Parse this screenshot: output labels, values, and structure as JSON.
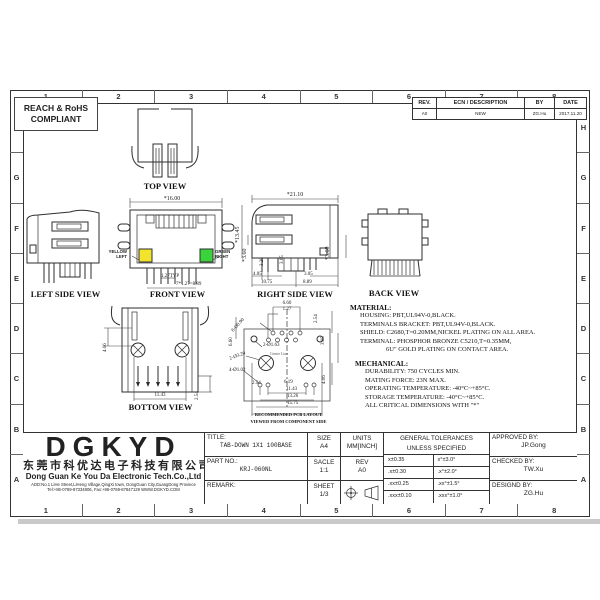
{
  "compliance": {
    "line1": "REACH & RoHS",
    "line2": "COMPLIANT"
  },
  "border": {
    "columns": [
      "1",
      "2",
      "3",
      "4",
      "5",
      "6",
      "7",
      "8"
    ],
    "rows": [
      "H",
      "G",
      "F",
      "E",
      "D",
      "C",
      "B",
      "A"
    ]
  },
  "revision": {
    "headers": [
      "REV.",
      "ECN / DESCRIPTION",
      "BY",
      "DATE"
    ],
    "rev": "A0",
    "description": "NEW",
    "by": "ZG.Hu",
    "date": "2017.11.20"
  },
  "views": {
    "top": {
      "caption": "TOP VIEW"
    },
    "left": {
      "caption": "LEFT SIDE VIEW"
    },
    "front": {
      "caption": "FRONT VIEW",
      "width": "*16.00",
      "pitch": "1.27TYP",
      "span": "7*1.27=8.89",
      "led_left_1": "YELLOW",
      "led_left_2": "LEFT",
      "led_right_1": "GREEN",
      "led_right_2": "RIGHT",
      "led_left_color": "#f2e42c",
      "led_right_color": "#3bd33b"
    },
    "right": {
      "caption": "RIGHT SIDE VIEW",
      "width": "*21.10",
      "height": "*13.45",
      "dim_360_left": "*3.60",
      "dim_320": "3.20",
      "dim_365": "3.65",
      "dim_360_right": "*3.60",
      "dim_405": "4.05",
      "dim_305": "3.05",
      "dim_1075": "10.75",
      "dim_889": "8.89"
    },
    "back": {
      "caption": "BACK VIEW"
    },
    "bottom": {
      "caption": "BOTTOM VIEW",
      "dim_406": "4.06",
      "dim_1143": "11.43",
      "dim_254": "2.54"
    },
    "pcb": {
      "caption1": "RECOMMENDED PCB LAYOUT",
      "caption2": "VIEWED FROM COMPONENT SIDE",
      "dim_660_top": "6.60",
      "dim_127": "1.27",
      "dim_254_right": "2.54",
      "dim_305": "3.05",
      "dim_406": "4.06",
      "dim_660_left": "6.60",
      "holes_090": "8-Ø0.90",
      "holes_163": "2-Ø1.63",
      "holes_320": "2-Ø3.20",
      "holes_102": "4-Ø1.02",
      "dim_254_bottom": "2.54",
      "dim_619": "6.19",
      "dim_1143": "11.43",
      "dim_1326": "13.26",
      "dim_1575": "15.75",
      "centre_line": "Centre Line"
    }
  },
  "material": {
    "heading": "MATERIAL:",
    "lines": [
      "HOUSING: PBT,UL94V-0,BLACK.",
      "TERMINALS BRACKET: PBT,UL94V-0,BLACK.",
      "SHIELD: C2680,T=0.20MM,NICKEL PLATING ON ALL AREA.",
      "TERMINAL: PHOSPHOR BRONZE C5210,T=0.35MM,",
      "6U\" GOLD PLATING ON CONTACT AREA."
    ]
  },
  "mechanical": {
    "heading": "MECHANICAL:",
    "lines": [
      "DURABILITY: 750 CYCLES MIN.",
      "MATING FORCE: 23N MAX.",
      "OPERATING TEMPERATURE: -40°C~+85°C.",
      "STORAGE TEMPERATURE: -40°C~+85°C.",
      "ALL CRITICAL DIMENSIONS WITH \"*\""
    ]
  },
  "title_block": {
    "logo": "DGKYD",
    "company_cn": "东莞市科优达电子科技有限公司",
    "company_en": "Dong Guan Ke You Da Electronic Tech.Co.,Ltd",
    "address": "ADD:No.1 LiHe Street,LiHeng Village,QingXi town, DongGuan City,GuangDong Province",
    "contact": "Tel:+86-0769-87334806, Fax:+86-0769-87847129 WWW.DGKYD.COM",
    "title_label": "TITLE:",
    "title_value": "TAB-DOWN 1X1 100BASE",
    "part_label": "PART NO.:",
    "part_value": "KRJ-060NL",
    "remark_label": "REMARK:",
    "size_label": "SIZE",
    "size_value": "A4",
    "scale_label": "SACLE",
    "scale_value": "1:1",
    "sheet_label": "SHEET",
    "sheet_value": "1/3",
    "units_label": "UNITS",
    "units_value": "MM[INCH]",
    "rev_label": "REV",
    "rev_value": "A0",
    "tol_header_1": "GENERAL TOLERANCES",
    "tol_header_2": "UNLESS SPECIFIED",
    "tolerances": [
      [
        "x±0.35",
        "x°±3.0°"
      ],
      [
        ".x±0.30",
        ".x°±2.0°"
      ],
      [
        ".xx±0.25",
        ".xx°±1.5°"
      ],
      [
        ".xxx±0.10",
        ".xxx°±1.0°"
      ]
    ],
    "approved_label": "APPROVED BY:",
    "approved_value": "JP.Gong",
    "checked_label": "CHECKED BY:",
    "checked_value": "TW.Xu",
    "designed_label": "DESIGND BY:",
    "designed_value": "ZG.Hu"
  }
}
